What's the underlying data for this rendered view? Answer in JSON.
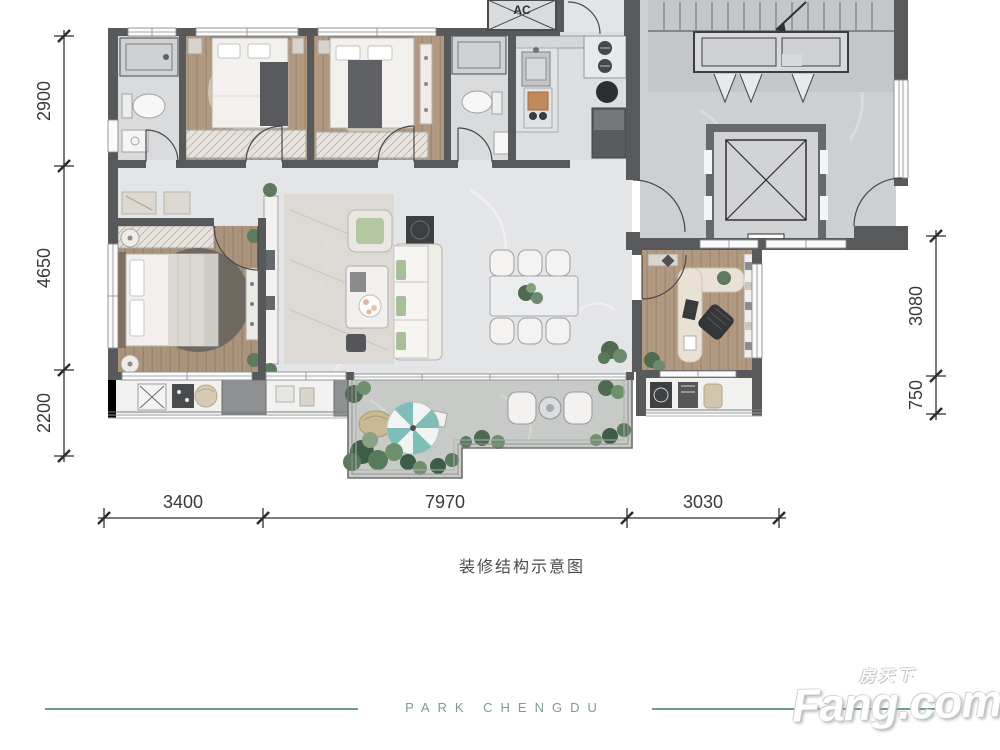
{
  "plan": {
    "ac_label": "AC",
    "caption": "装修结构示意图",
    "dims": {
      "left": [
        "2900",
        "4650",
        "2200"
      ],
      "right": [
        "3080",
        "750"
      ],
      "bottom": [
        "3400",
        "7970",
        "3030"
      ]
    }
  },
  "footer": {
    "brand": "PARK CHENGDU",
    "logo_cn": "房天下",
    "logo_en": "Fang.com"
  },
  "colors": {
    "accent_teal": "#6f9a97",
    "wall": "#58595b",
    "wood": "#b29a82",
    "umbrella_teal": "#7fbdb9"
  }
}
